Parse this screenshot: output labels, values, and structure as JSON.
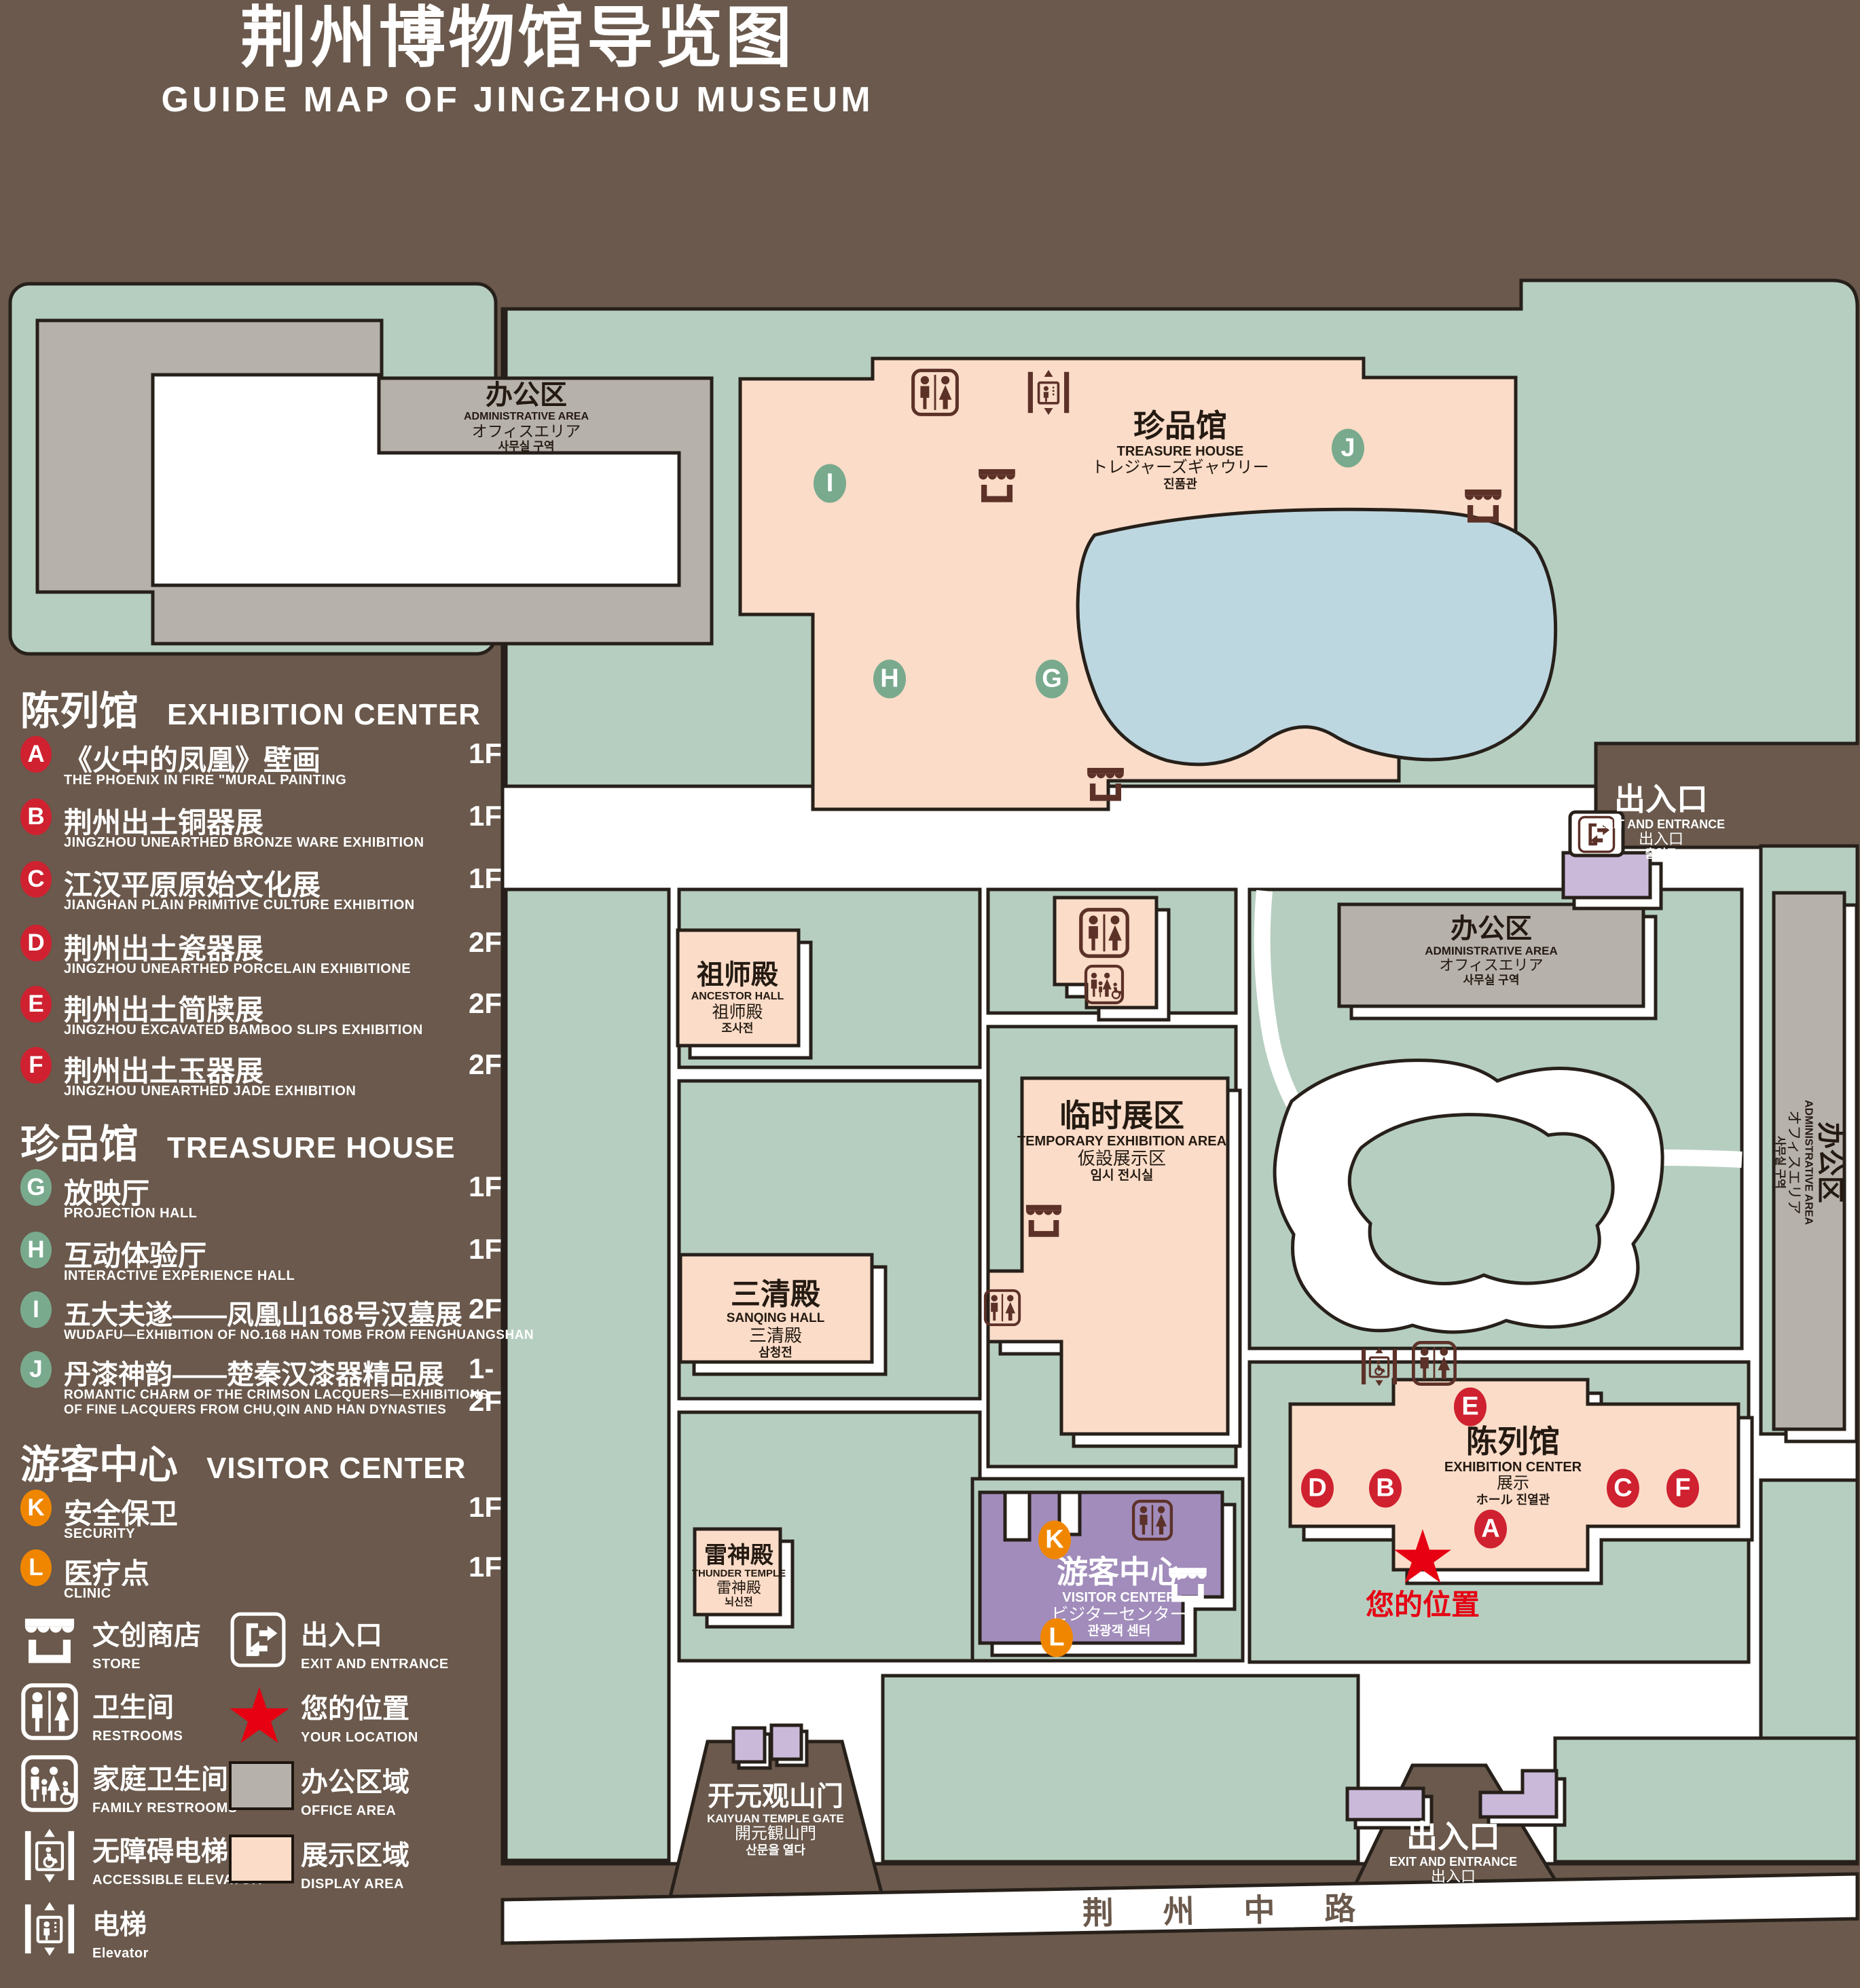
{
  "title": {
    "zh": "荆州博物馆导览图",
    "en": "GUIDE MAP OF JINGZHOU MUSEUM"
  },
  "colors": {
    "background": "#6a594c",
    "campus_green": "#b6cec0",
    "path_white": "#ffffff",
    "office_gray": "#b7b1ac",
    "display_pink": "#fadcc8",
    "pond_blue": "#bdd7e0",
    "visitor_purple": "#a18cbb",
    "gate_purple": "#cbb9da",
    "icon_maroon": "#5c3128",
    "badge_red": "#cf2130",
    "badge_green": "#79aa8e",
    "badge_orange": "#f08600",
    "location_red": "#e60012"
  },
  "legend": {
    "sections": [
      {
        "zh": "陈列馆",
        "en": "EXHIBITION CENTER",
        "items": [
          {
            "letter": "A",
            "zh": "《火中的凤凰》壁画",
            "en": "THE PHOENIX IN FIRE \"MURAL PAINTING",
            "floor": "1F"
          },
          {
            "letter": "B",
            "zh": "荆州出土铜器展",
            "en": "JINGZHOU UNEARTHED BRONZE WARE EXHIBITION",
            "floor": "1F"
          },
          {
            "letter": "C",
            "zh": "江汉平原原始文化展",
            "en": "JIANGHAN PLAIN PRIMITIVE CULTURE EXHIBITION",
            "floor": "1F"
          },
          {
            "letter": "D",
            "zh": "荆州出土瓷器展",
            "en": "JINGZHOU UNEARTHED PORCELAIN EXHIBITIONE",
            "floor": "2F"
          },
          {
            "letter": "E",
            "zh": "荆州出土简牍展",
            "en": "JINGZHOU EXCAVATED BAMBOO SLIPS EXHIBITION",
            "floor": "2F"
          },
          {
            "letter": "F",
            "zh": "荆州出土玉器展",
            "en": "JINGZHOU UNEARTHED JADE EXHIBITION",
            "floor": "2F"
          }
        ]
      },
      {
        "zh": "珍品馆",
        "en": "TREASURE HOUSE",
        "items": [
          {
            "letter": "G",
            "zh": "放映厅",
            "en": "PROJECTION HALL",
            "floor": "1F"
          },
          {
            "letter": "H",
            "zh": "互动体验厅",
            "en": "INTERACTIVE EXPERIENCE HALL",
            "floor": "1F"
          },
          {
            "letter": "I",
            "zh": "五大夫遂——凤凰山168号汉墓展",
            "en": "WUDAFU—EXHIBITION OF NO.168 HAN TOMB FROM FENGHUANGSHAN",
            "floor": "2F"
          },
          {
            "letter": "J",
            "zh": "丹漆神韵——楚秦汉漆器精品展",
            "en": "ROMANTIC CHARM OF THE CRIMSON LACQUERS—EXHIBITIONS OF FINE LACQUERS FROM CHU,QIN AND HAN DYNASTIES",
            "floor": "1-2F"
          }
        ]
      },
      {
        "zh": "游客中心",
        "en": "VISITOR CENTER",
        "items": [
          {
            "letter": "K",
            "zh": "安全保卫",
            "en": "SECURITY",
            "floor": "1F"
          },
          {
            "letter": "L",
            "zh": "医疗点",
            "en": "CLINIC",
            "floor": "1F"
          }
        ]
      }
    ],
    "symbols_left": [
      {
        "icon": "store-icon",
        "zh": "文创商店",
        "en": "STORE"
      },
      {
        "icon": "restrooms-icon",
        "zh": "卫生间",
        "en": "RESTROOMS"
      },
      {
        "icon": "family-restrooms-icon",
        "zh": "家庭卫生间",
        "en": "FAMILY RESTROOMS"
      },
      {
        "icon": "accessible-elevator-icon",
        "zh": "无障碍电梯",
        "en": "ACCESSIBLE ELEVATOR"
      },
      {
        "icon": "elevator-icon",
        "zh": "电梯",
        "en": "Elevator"
      }
    ],
    "symbols_right": [
      {
        "icon": "exit-entrance-icon",
        "zh": "出入口",
        "en": "EXIT AND ENTRANCE"
      },
      {
        "icon": "your-location-icon",
        "zh": "您的位置",
        "en": "YOUR LOCATION"
      },
      {
        "icon": "office-area-swatch",
        "zh": "办公区域",
        "en": "OFFICE AREA"
      },
      {
        "icon": "display-area-swatch",
        "zh": "展示区域",
        "en": "DISPLAY AREA"
      }
    ]
  },
  "map": {
    "buildings": {
      "admin_nw": {
        "zh": "办公区",
        "en": "ADMINISTRATIVE AREA",
        "ja": "オフィスエリア",
        "ko": "사무실 구역"
      },
      "treasure_house": {
        "zh": "珍品馆",
        "en": "TREASURE HOUSE",
        "ja": "トレジャーズギャウリー",
        "ko": "진품관"
      },
      "ancestor_hall": {
        "zh": "祖师殿",
        "en": "ANCESTOR HALL",
        "ja": "祖师殿",
        "ko": "조사전"
      },
      "temporary_area": {
        "zh": "临时展区",
        "en": "TEMPORARY EXHIBITION AREA",
        "ja": "仮設展示区",
        "ko": "임시 전시실"
      },
      "admin_east": {
        "zh": "办公区",
        "en": "ADMINISTRATIVE AREA",
        "ja": "オフィスエリア",
        "ko": "사무실 구역"
      },
      "sanqing_hall": {
        "zh": "三清殿",
        "en": "SANQING HALL",
        "ja": "三清殿",
        "ko": "삼청전"
      },
      "thunder_temple": {
        "zh": "雷神殿",
        "en": "THUNDER TEMPLE",
        "ja": "雷神殿",
        "ko": "뇌신전"
      },
      "visitor_center": {
        "zh": "游客中心",
        "en": "VISITOR CENTER",
        "ja": "ビジターセンター",
        "ko": "관광객 센터"
      },
      "exhibition_center": {
        "zh": "陈列馆",
        "en": "EXHIBITION CENTER",
        "ja": "展示",
        "ko": "ホール 진열관"
      },
      "admin_strip": {
        "zh": "办公区",
        "en": "ADMINISTRATIVE AREA",
        "ja": "オフィスエリア",
        "ko": "사무실 구역"
      },
      "exit_ne": {
        "zh": "出入口",
        "en": "EXIT AND ENTRANCE",
        "ja": "出入口",
        "ko": "출입구"
      },
      "exit_south": {
        "zh": "出入口",
        "en": "EXIT AND ENTRANCE",
        "ja": "出入口",
        "ko": "출입구"
      },
      "kaiyuan_gate": {
        "zh": "开元观山门",
        "en": "KAIYUAN TEMPLE GATE",
        "ja": "開元観山門",
        "ko": "산문을 열다"
      }
    },
    "your_location": "您的位置",
    "road": "荆 州 中 路",
    "markers": [
      {
        "letter": "I",
        "color": "green"
      },
      {
        "letter": "J",
        "color": "green"
      },
      {
        "letter": "H",
        "color": "green"
      },
      {
        "letter": "G",
        "color": "green"
      },
      {
        "letter": "E",
        "color": "red"
      },
      {
        "letter": "D",
        "color": "red"
      },
      {
        "letter": "B",
        "color": "red"
      },
      {
        "letter": "C",
        "color": "red"
      },
      {
        "letter": "F",
        "color": "red"
      },
      {
        "letter": "A",
        "color": "red"
      },
      {
        "letter": "K",
        "color": "orange"
      },
      {
        "letter": "L",
        "color": "orange"
      }
    ]
  }
}
